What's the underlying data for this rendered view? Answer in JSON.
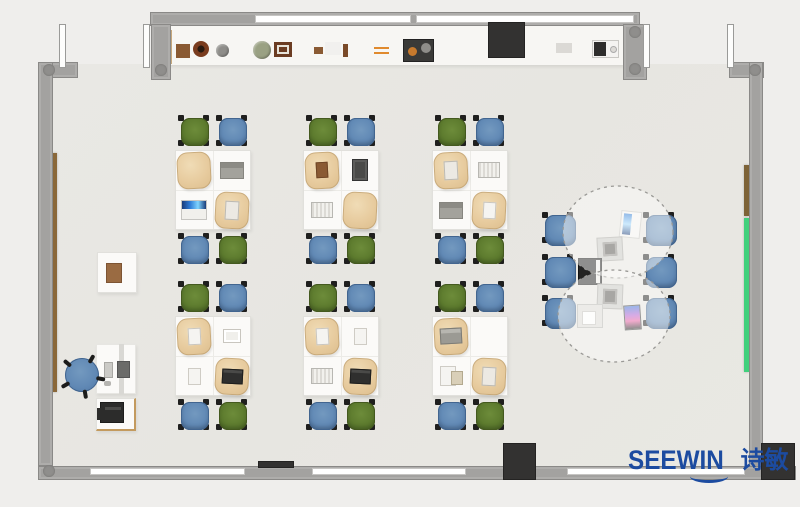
{
  "logo": {
    "brand": "SEEWIN",
    "cn": "诗敏",
    "color": "#1c4ba0"
  },
  "colors": {
    "background": "#efeeec",
    "floor": "#e8e7e2",
    "alcove": "#f7f6f3",
    "wall": "#a3a2a0",
    "window": "#ffffff",
    "pillar": "#333231",
    "chair_green": "#5d7b2e",
    "chair_blue": "#6189b5",
    "desk": "#fbfaf8",
    "bag": "#e7cb9e",
    "board_green": "#41d07c",
    "board_brown": "#8a683a",
    "logo_blue": "#1c4ba0"
  },
  "scene": {
    "room": {
      "floor": {
        "x": 52,
        "y": 64,
        "w": 699,
        "h": 402
      },
      "alcove": {
        "x": 165,
        "y": 25,
        "w": 459,
        "h": 40
      }
    },
    "walls": [
      {
        "n": "top-wall",
        "x": 150,
        "y": 12,
        "w": 490,
        "h": 14
      },
      {
        "n": "top-wall-post-left",
        "x": 151,
        "y": 24,
        "w": 20,
        "h": 56
      },
      {
        "n": "top-wall-post-right",
        "x": 623,
        "y": 24,
        "w": 24,
        "h": 56
      },
      {
        "n": "top-right-corner",
        "x": 729,
        "y": 62,
        "w": 35,
        "h": 16
      },
      {
        "n": "right-wall",
        "x": 749,
        "y": 62,
        "w": 14,
        "h": 418
      },
      {
        "n": "top-left-corner",
        "x": 38,
        "y": 62,
        "w": 40,
        "h": 16
      },
      {
        "n": "left-wall",
        "x": 38,
        "y": 62,
        "w": 15,
        "h": 404
      },
      {
        "n": "bottom-wall",
        "x": 38,
        "y": 466,
        "w": 758,
        "h": 14
      }
    ],
    "windows": [
      {
        "n": "top-window-1",
        "x": 255,
        "y": 15,
        "w": 156,
        "h": 8
      },
      {
        "n": "top-window-2",
        "x": 416,
        "y": 15,
        "w": 218,
        "h": 8
      },
      {
        "n": "bottom-window-1",
        "x": 90,
        "y": 468,
        "w": 155,
        "h": 7
      },
      {
        "n": "bottom-window-2",
        "x": 312,
        "y": 468,
        "w": 154,
        "h": 7
      },
      {
        "n": "bottom-window-3",
        "x": 567,
        "y": 468,
        "w": 178,
        "h": 7
      }
    ],
    "doors": [
      {
        "n": "door-leaf-left-a",
        "x": 59,
        "y": 24,
        "w": 7,
        "h": 44
      },
      {
        "n": "door-leaf-left-b",
        "x": 143,
        "y": 24,
        "w": 7,
        "h": 44
      },
      {
        "n": "door-leaf-right-a",
        "x": 643,
        "y": 24,
        "w": 7,
        "h": 44
      },
      {
        "n": "door-leaf-right-b",
        "x": 727,
        "y": 24,
        "w": 7,
        "h": 44
      }
    ],
    "joints": [
      {
        "x": 43,
        "y": 64
      },
      {
        "x": 155,
        "y": 64
      },
      {
        "x": 629,
        "y": 26
      },
      {
        "x": 629,
        "y": 63
      },
      {
        "x": 749,
        "y": 64
      },
      {
        "x": 43,
        "y": 465
      }
    ],
    "boards": [
      {
        "n": "left-wall-rail-brown",
        "x": 52,
        "y": 153,
        "w": 5,
        "h": 239,
        "c": "#8a683a"
      },
      {
        "n": "right-wall-rail-brown",
        "x": 744,
        "y": 165,
        "w": 5,
        "h": 51,
        "c": "#7d6337"
      },
      {
        "n": "right-wall-green-board",
        "x": 744,
        "y": 218,
        "w": 5,
        "h": 154,
        "c": "#41d07c"
      }
    ],
    "pillars": [
      {
        "n": "pillar-top",
        "x": 488,
        "y": 22,
        "w": 37,
        "h": 36
      },
      {
        "n": "pillar-bottom-mid",
        "x": 503,
        "y": 443,
        "w": 33,
        "h": 37
      },
      {
        "n": "pillar-bottom-right",
        "x": 761,
        "y": 443,
        "w": 34,
        "h": 37
      },
      {
        "n": "wall-vent",
        "x": 258,
        "y": 461,
        "w": 36,
        "h": 7
      }
    ],
    "shelf_items": [
      {
        "t": "sq",
        "x": 165,
        "y": 30,
        "w": 7,
        "h": 34,
        "c": "#c7a87c"
      },
      {
        "t": "sq",
        "x": 176,
        "y": 44,
        "w": 14,
        "h": 14,
        "c": "#8a5a33"
      },
      {
        "t": "ring",
        "x": 193,
        "y": 41,
        "w": 16,
        "h": 16,
        "c": "#7a3c1e"
      },
      {
        "t": "circle",
        "x": 216,
        "y": 44,
        "w": 13,
        "h": 13,
        "c": "#8e8d89"
      },
      {
        "t": "circle",
        "x": 253,
        "y": 41,
        "w": 18,
        "h": 18,
        "c": "#9aa183"
      },
      {
        "t": "frame",
        "x": 274,
        "y": 42,
        "w": 18,
        "h": 15,
        "c": "#6b3c22"
      },
      {
        "t": "sq",
        "x": 314,
        "y": 47,
        "w": 9,
        "h": 7,
        "c": "#8a5a33"
      },
      {
        "t": "box",
        "x": 325,
        "y": 42,
        "w": 16,
        "h": 13,
        "c": "#f1f0ee"
      },
      {
        "t": "sq",
        "x": 343,
        "y": 44,
        "w": 5,
        "h": 13,
        "c": "#7a4a28"
      },
      {
        "t": "lines",
        "x": 374,
        "y": 47,
        "w": 15,
        "h": 7,
        "c": "#e08a2d"
      },
      {
        "t": "tray",
        "x": 403,
        "y": 39,
        "w": 31,
        "h": 23,
        "c": "#3a3a38"
      },
      {
        "t": "box",
        "x": 556,
        "y": 43,
        "w": 16,
        "h": 10,
        "c": "#dbd9d5"
      },
      {
        "t": "device",
        "x": 592,
        "y": 40,
        "w": 27,
        "h": 18,
        "c": "#2e2d2c"
      }
    ],
    "clusters": {
      "origin_cols": [
        173,
        301,
        430
      ],
      "origin_rows": [
        118,
        284
      ],
      "chair_positions": {
        "tl": [
          8,
          0
        ],
        "tr": [
          46,
          0
        ],
        "bl": [
          8,
          118
        ],
        "br": [
          46,
          118
        ]
      },
      "chair_colors": {
        "tl": "green",
        "tr": "blue",
        "bl": "blue",
        "br": "green"
      },
      "desk_centers": {
        "tl": [
          21,
          52
        ],
        "tr": [
          59,
          52
        ],
        "bl": [
          21,
          92
        ],
        "br": [
          59,
          92
        ]
      },
      "sets": [
        {
          "tl": "bag",
          "tr": "laptop-gray",
          "bl": "laptop-white",
          "br": "bag-book"
        },
        {
          "tl": "bag-box",
          "tr": "tablet-dark",
          "bl": "book-gray",
          "br": "bag"
        },
        {
          "tl": "bag-book",
          "tr": "book-gray",
          "bl": "laptop-gray",
          "br": "bag-paper"
        },
        {
          "tl": "bag-paper",
          "tr": "book-white",
          "bl": "paper",
          "br": "bag-laptop"
        },
        {
          "tl": "bag-paper",
          "tr": "paper",
          "bl": "book-gray",
          "br": "bag-laptop"
        },
        {
          "tl": "bag-laptopgray",
          "tr": "none",
          "bl": "paper-book",
          "br": "bag-book"
        }
      ]
    },
    "collab": {
      "chairs": [
        [
          545,
          215
        ],
        [
          545,
          257
        ],
        [
          545,
          298
        ],
        [
          646,
          215
        ],
        [
          646,
          257
        ],
        [
          646,
          298
        ]
      ],
      "devices": [
        {
          "t": "tablet-blue",
          "x": 620,
          "y": 211,
          "w": 21,
          "h": 27,
          "r": 6
        },
        {
          "t": "folder-gray",
          "x": 597,
          "y": 237,
          "w": 26,
          "h": 24,
          "r": -3
        },
        {
          "t": "laptop-black",
          "x": 578,
          "y": 258,
          "w": 24,
          "h": 27,
          "r": 0
        },
        {
          "t": "folder-gray",
          "x": 597,
          "y": 284,
          "w": 26,
          "h": 25,
          "r": 2
        },
        {
          "t": "laptop-white2",
          "x": 577,
          "y": 304,
          "w": 26,
          "h": 24,
          "r": 0
        },
        {
          "t": "phone-color",
          "x": 624,
          "y": 305,
          "w": 17,
          "h": 25,
          "r": -4
        }
      ]
    },
    "teacher": {
      "side_desk": {
        "x": 97,
        "y": 252,
        "w": 40,
        "h": 41
      },
      "side_item": {
        "x": 106,
        "y": 263,
        "w": 16,
        "h": 20,
        "c": "#9a6b42"
      },
      "chair": {
        "x": 65,
        "y": 358,
        "w": 34,
        "h": 34
      },
      "desk": {
        "x": 96,
        "y": 344,
        "w": 40,
        "h": 50
      },
      "divider": {
        "x": 119,
        "y": 344,
        "w": 5,
        "h": 50,
        "c": "#d9d8d4"
      },
      "monitor": {
        "x": 117,
        "y": 361,
        "w": 13,
        "h": 17,
        "c": "#6b6b69"
      },
      "keyboard": {
        "x": 104,
        "y": 362,
        "w": 9,
        "h": 16,
        "c": "#cbcac6"
      },
      "mouse": {
        "x": 104,
        "y": 381,
        "w": 7,
        "h": 5,
        "c": "#b5b4b0"
      },
      "printer_table": {
        "x": 96,
        "y": 398,
        "w": 40,
        "h": 33
      },
      "printer": {
        "x": 100,
        "y": 402,
        "w": 24,
        "h": 21,
        "c": "#2c2c2b"
      }
    }
  }
}
